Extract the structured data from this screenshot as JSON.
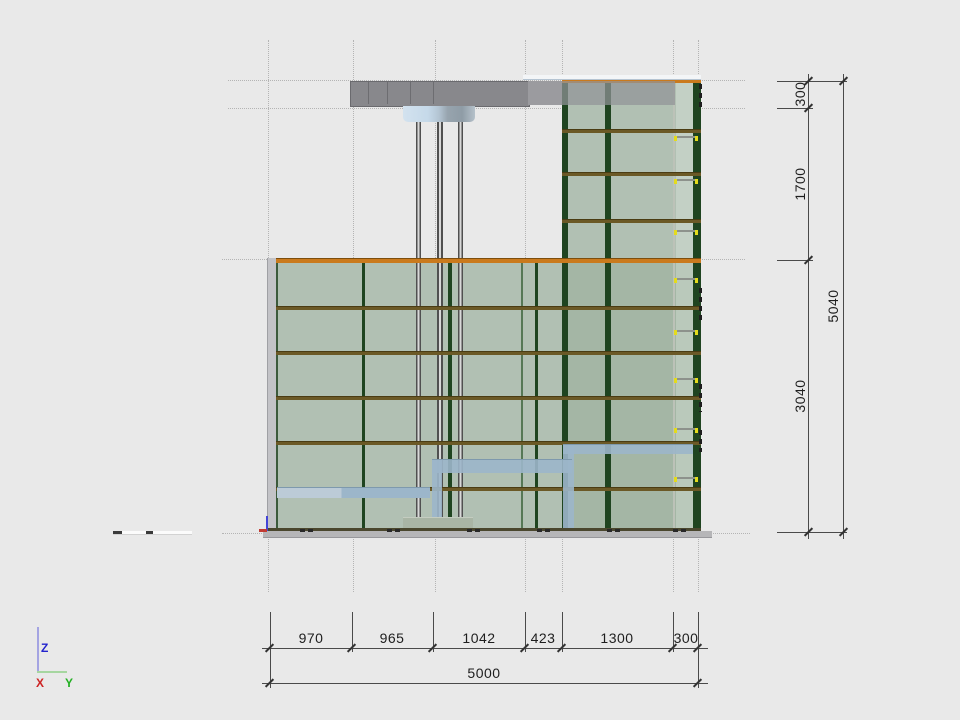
{
  "view": {
    "type": "cad-elevation-view",
    "background": "#e9e9e9"
  },
  "dimensions": {
    "bottom_chain": [
      "970",
      "965",
      "1042",
      "423",
      "1300",
      "300"
    ],
    "bottom_total": "5000",
    "right_chain": [
      "300",
      "1700",
      "3040"
    ],
    "right_total": "5040"
  },
  "axis_gizmo": {
    "z_label": "Z",
    "x_label": "X",
    "y_label": "Y",
    "z_color": "#2323cd",
    "x_color": "#cd2323",
    "y_color": "#23b023"
  },
  "colors": {
    "glass_green": "#b1c0b3",
    "mullion_dark_green": "#1f4420",
    "slab_edge_orange": "#ca7a1d",
    "floor_line_brown": "#6b5926",
    "canopy_gray": "#88888c",
    "stair_blue": "#9cb6ca",
    "handle_yellow": "#e4dc1c",
    "dimension_line": "#4a4a4a",
    "grid_dotted": "#b4b4b4"
  }
}
